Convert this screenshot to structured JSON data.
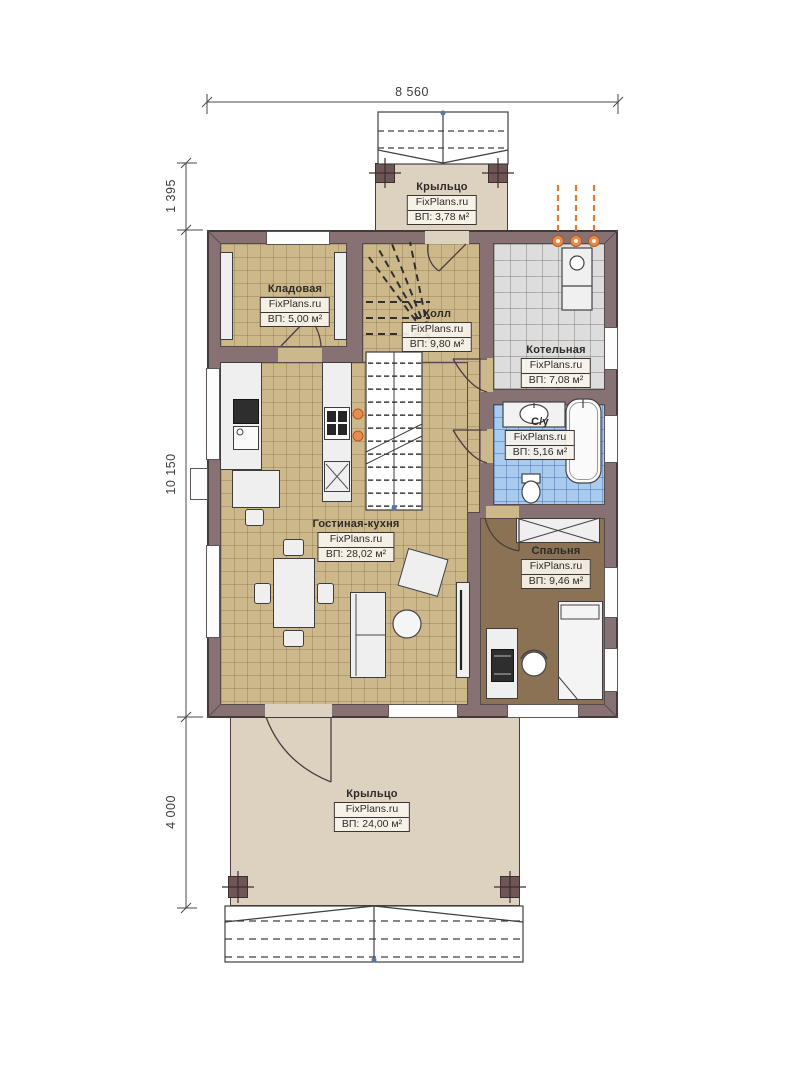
{
  "watermark": "FixPlans.ru",
  "dimensions": {
    "top_width": "8 560",
    "porch_top_depth": "1 395",
    "house_depth": "10 150",
    "porch_bottom_depth": "4 000"
  },
  "rooms": {
    "porch_top": {
      "name": "Крыльцо",
      "area": "ВП: 3,78 м²"
    },
    "storage": {
      "name": "Кладовая",
      "area": "ВП: 5,00 м²"
    },
    "hall": {
      "name": "Холл",
      "area": "ВП: 9,80 м²"
    },
    "boiler": {
      "name": "Котельная",
      "area": "ВП: 7,08 м²"
    },
    "bathroom": {
      "name": "С/у",
      "area": "ВП: 5,16 м²"
    },
    "living_kitchen": {
      "name": "Гостиная-кухня",
      "area": "ВП: 28,02 м²"
    },
    "bedroom": {
      "name": "Спальня",
      "area": "ВП: 9,46 м²"
    },
    "porch_bottom": {
      "name": "Крыльцо",
      "area": "ВП: 24,00 м²"
    }
  },
  "colors": {
    "wall": "#877173",
    "floor_wood": "#cdb88c",
    "floor_tile_gray": "#dcdddc",
    "floor_tile_blue": "#a9cbee",
    "floor_bedroom": "#8b7254",
    "porch": "#ddd2c0",
    "accent_orange": "#e07a35"
  }
}
